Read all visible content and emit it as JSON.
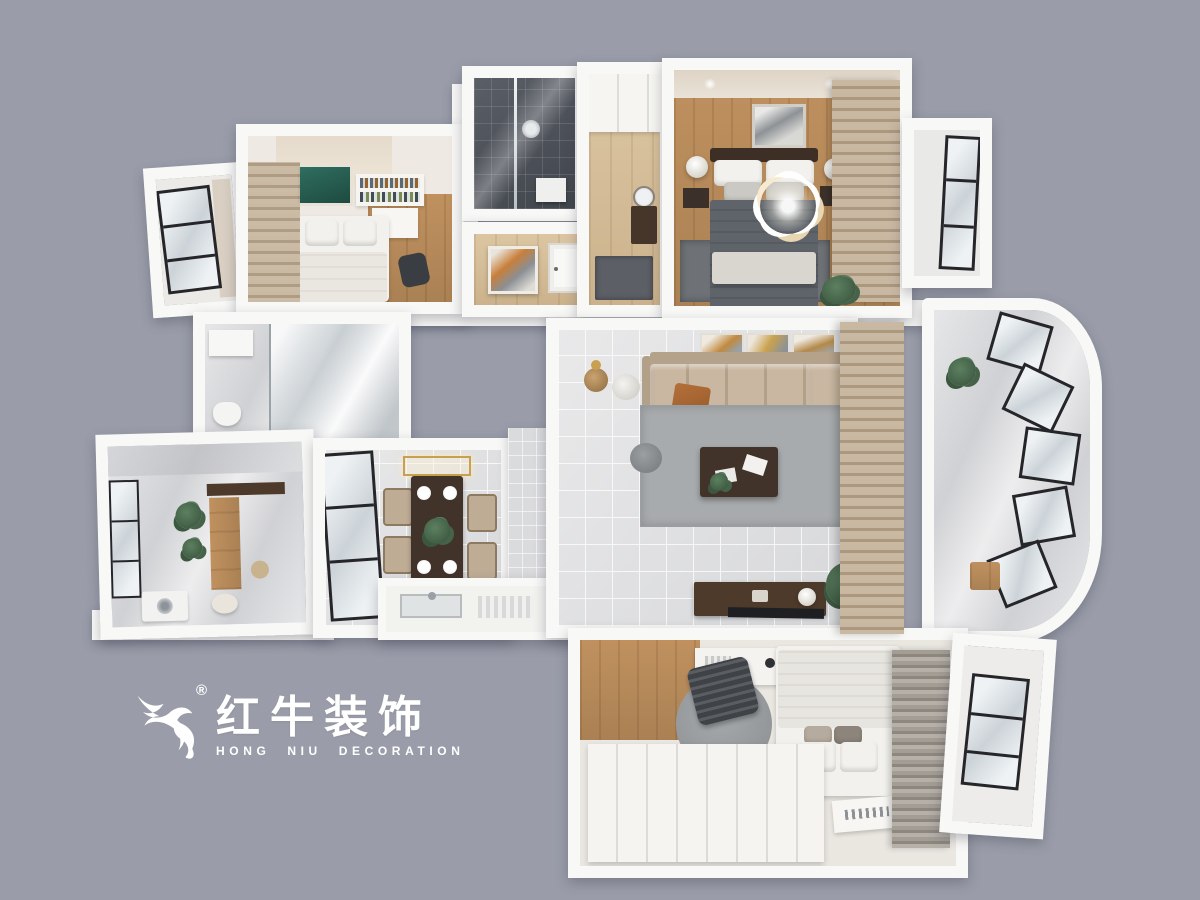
{
  "logo": {
    "icon": "bull-logo-icon",
    "registered_mark": "®",
    "name_cn": "红牛装饰",
    "name_en": "HONG NIU DECORATION",
    "text_color": "#ffffff"
  },
  "palette": {
    "bg": "#9a9da9",
    "wall": "#f8f8f6",
    "wood": "#c0915f",
    "wood_light": "#dcc6a2",
    "tile_gray": "#e0e1e3",
    "tile_dark_a": "#5a5e66",
    "tile_dark_b": "#41454c",
    "marble_a": "#e6e7e9",
    "marble_b": "#d0d1d4",
    "sofa": "#c9b7a1",
    "sofa_dark": "#b3a089",
    "bed_white": "#f2f1ed",
    "duvet": "#5f646b",
    "rug": "#a8abad",
    "rug_dark": "#6e7276",
    "table_brown": "#42332a",
    "console_brown": "#4e3a2b",
    "chair_tan": "#bfac95",
    "frame_black": "#26262a",
    "curtain_a": "#c9b9a3",
    "curtain_b": "#ab987f",
    "curtain_gray_a": "#b5b0a8",
    "curtain_gray_b": "#8d8780",
    "glass_a": "#eef2f4",
    "glass_b": "#ccd3d8",
    "plant_a": "#5d8060",
    "plant_b": "#35503a",
    "art_green": "#2f6f60",
    "gold": "#c8a050",
    "logo_text": "#ffffff"
  }
}
